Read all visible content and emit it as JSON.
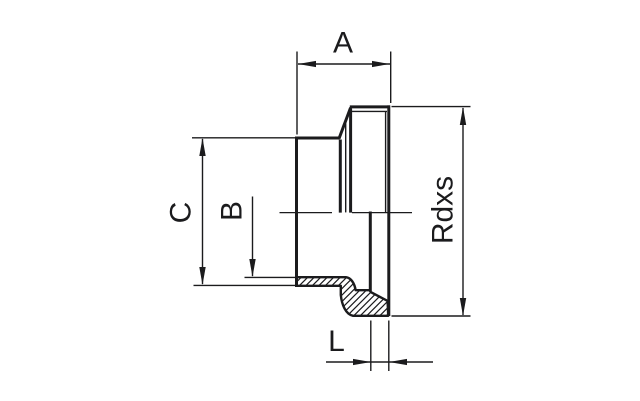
{
  "diagram": {
    "type": "technical-drawing-half-section",
    "subject": "threaded pipe fitting with flanged sealing lip",
    "background_color": "#ffffff",
    "line_color": "#1b1b1d",
    "labels": {
      "a": "A",
      "b": "B",
      "c": "C",
      "l": "L",
      "thread": "Rdxs"
    }
  }
}
